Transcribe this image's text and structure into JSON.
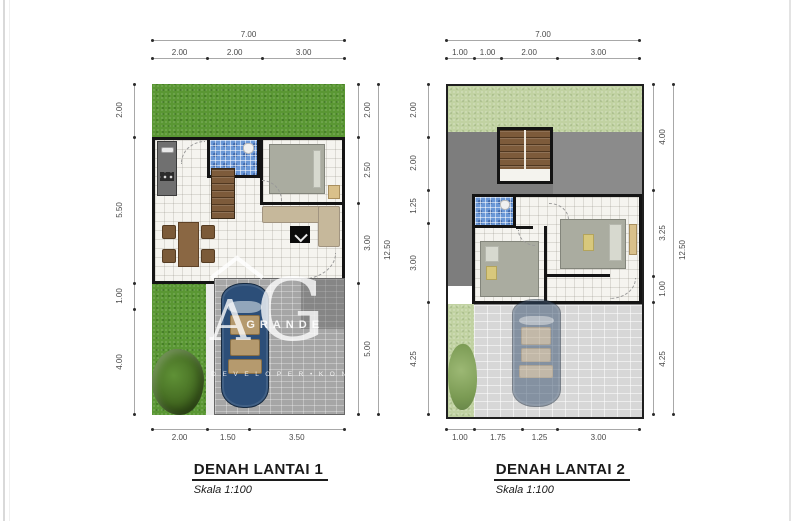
{
  "colors": {
    "wall": "#141414",
    "grass": "#5a9733",
    "grass_pale": "#c1d2a2",
    "roof": "#7d7d7d",
    "tile_floor": "#f5f4ef",
    "bath_tile": "#6a97d6",
    "stair_wood": "#7d5b3b",
    "paver": "#a6a6a6",
    "paver_faded": "#d7d7d7",
    "car_blue": "#2c4e78",
    "bed_gray": "#aaaca0",
    "sofa_beige": "#c6b89b",
    "wood_brown": "#8a6743"
  },
  "watermark": {
    "monogram_a": "A",
    "monogram_g": "G",
    "name": "GRANDE",
    "tagline": "D E V E L O P E R • K O N T R A K T O R"
  },
  "plans": [
    {
      "title": "DENAH LANTAI 1",
      "scale": "Skala 1:100",
      "dims": {
        "top_total": [
          "7.00"
        ],
        "top": [
          "2.00",
          "2.00",
          "3.00"
        ],
        "bottom": [
          "2.00",
          "1.50",
          "3.50"
        ],
        "left": [
          "2.00",
          "5.50",
          "1.00",
          "4.00"
        ],
        "right": [
          "2.00",
          "2.50",
          "3.00",
          "5.00"
        ],
        "right_total": [
          "12.50"
        ]
      }
    },
    {
      "title": "DENAH LANTAI 2",
      "scale": "Skala 1:100",
      "dims": {
        "top_total": [
          "7.00"
        ],
        "top": [
          "1.00",
          "1.00",
          "2.00",
          "3.00"
        ],
        "bottom": [
          "1.00",
          "1.75",
          "1.25",
          "3.00"
        ],
        "left": [
          "2.00",
          "2.00",
          "1.25",
          "3.00",
          "4.25"
        ],
        "right": [
          "4.00",
          "3.25",
          "1.00",
          "4.25"
        ],
        "right_total": [
          "12.50"
        ]
      }
    }
  ]
}
